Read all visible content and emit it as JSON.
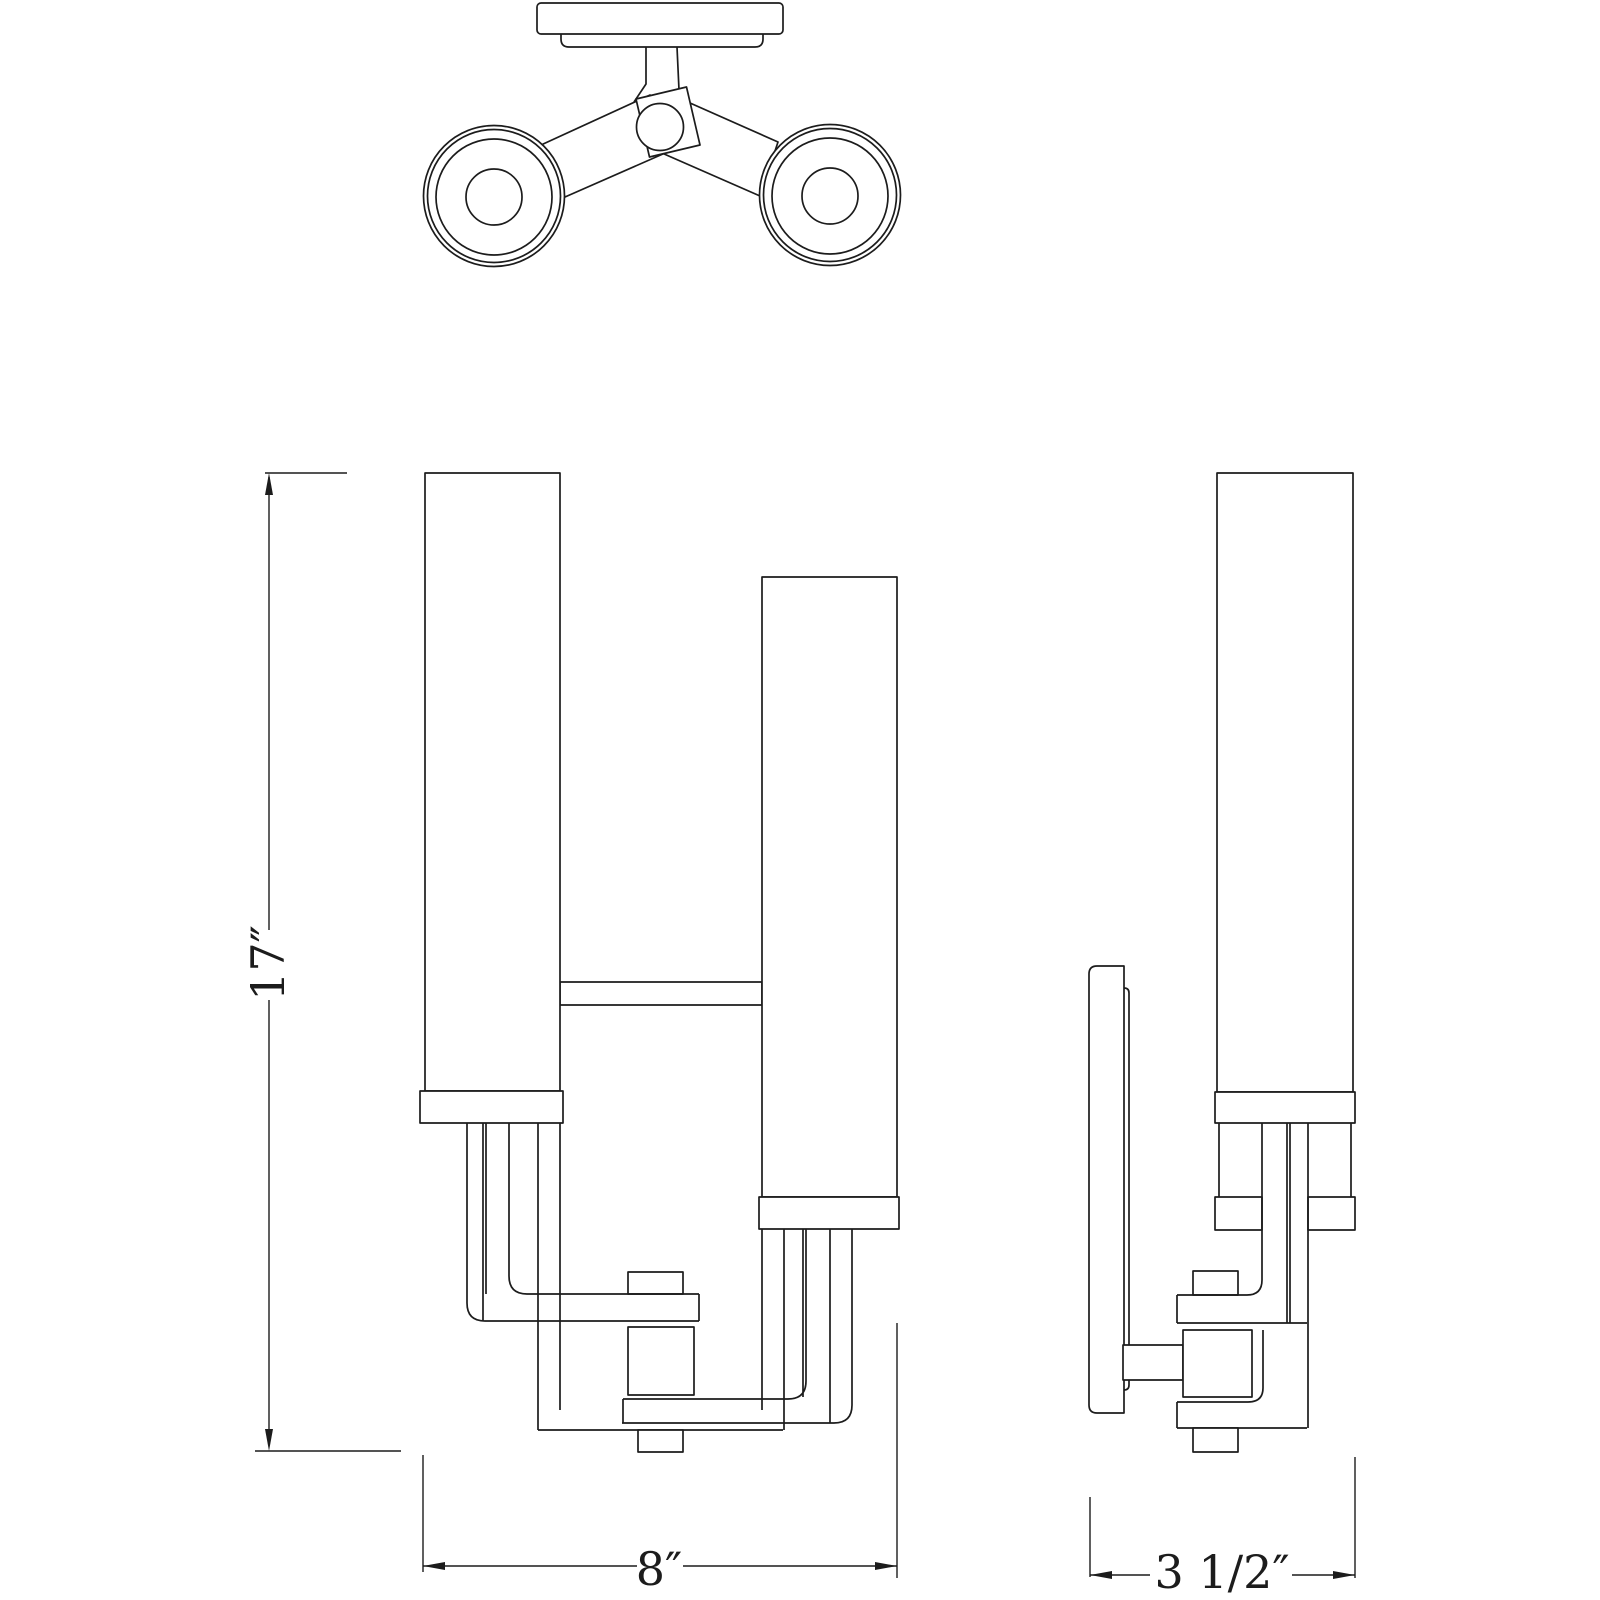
{
  "drawing": {
    "type": "technical-dimension-drawing",
    "subject": "two-light staggered cylinder wall sconce",
    "dimensions": {
      "height": {
        "label": "17″"
      },
      "width": {
        "label": "8″"
      },
      "depth": {
        "label": "3 1/2″"
      }
    },
    "colors": {
      "line": "#1c1c1c",
      "background": "#ffffff"
    }
  }
}
